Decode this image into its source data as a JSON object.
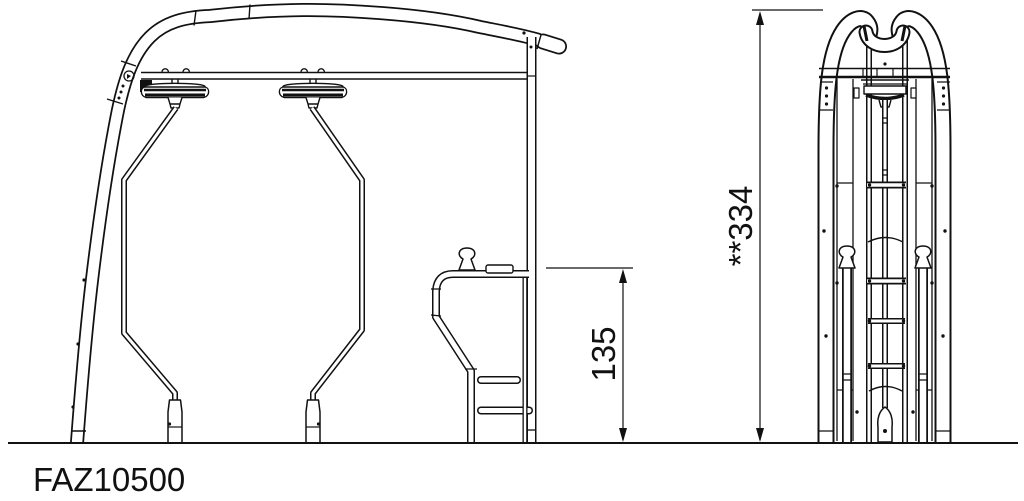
{
  "drawing": {
    "product_code": "FAZ10500",
    "colors": {
      "line": "#111111",
      "background": "#ffffff"
    },
    "dimensions": {
      "platform_height": {
        "value": "135",
        "orientation": "vertical"
      },
      "total_height": {
        "value": "**334",
        "orientation": "vertical"
      }
    }
  }
}
